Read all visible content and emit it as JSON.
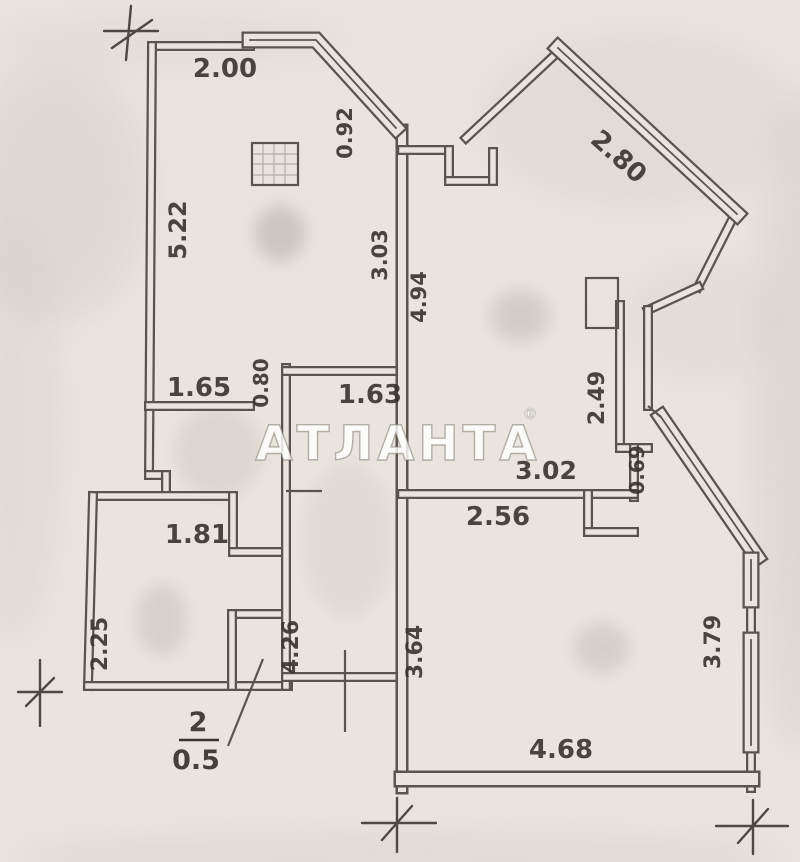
{
  "watermark": {
    "text": "АТЛАНТА",
    "registered_mark": "®"
  },
  "apartment_number_label": {
    "number": "2",
    "area_value": "0.5"
  },
  "dimension_labels": [
    {
      "text": "2.00",
      "x": 225,
      "y": 77,
      "rot": 0,
      "size": 26
    },
    {
      "text": "0.92",
      "x": 352,
      "y": 133,
      "rot": -90,
      "size": 21
    },
    {
      "text": "2.80",
      "x": 613,
      "y": 163,
      "rot": 42,
      "size": 26
    },
    {
      "text": "5.22",
      "x": 186,
      "y": 230,
      "rot": -90,
      "size": 24
    },
    {
      "text": "3.03",
      "x": 387,
      "y": 255,
      "rot": -90,
      "size": 21
    },
    {
      "text": "4.94",
      "x": 426,
      "y": 297,
      "rot": -90,
      "size": 21
    },
    {
      "text": "1.65",
      "x": 199,
      "y": 396,
      "rot": 0,
      "size": 26
    },
    {
      "text": "0.80",
      "x": 268,
      "y": 383,
      "rot": -90,
      "size": 20
    },
    {
      "text": "1.63",
      "x": 370,
      "y": 403,
      "rot": 0,
      "size": 26
    },
    {
      "text": "2.49",
      "x": 604,
      "y": 398,
      "rot": -90,
      "size": 22
    },
    {
      "text": "3.02",
      "x": 546,
      "y": 479,
      "rot": 0,
      "size": 25
    },
    {
      "text": "0.69",
      "x": 644,
      "y": 470,
      "rot": -90,
      "size": 20
    },
    {
      "text": "1.81",
      "x": 197,
      "y": 543,
      "rot": 0,
      "size": 26
    },
    {
      "text": "2.56",
      "x": 498,
      "y": 525,
      "rot": 0,
      "size": 26
    },
    {
      "text": "2.25",
      "x": 107,
      "y": 644,
      "rot": -90,
      "size": 22
    },
    {
      "text": "4.26",
      "x": 298,
      "y": 647,
      "rot": -90,
      "size": 22
    },
    {
      "text": "3.64",
      "x": 422,
      "y": 652,
      "rot": -90,
      "size": 22
    },
    {
      "text": "3.79",
      "x": 720,
      "y": 642,
      "rot": -90,
      "size": 22
    },
    {
      "text": "4.68",
      "x": 561,
      "y": 758,
      "rot": 0,
      "size": 26
    }
  ]
}
